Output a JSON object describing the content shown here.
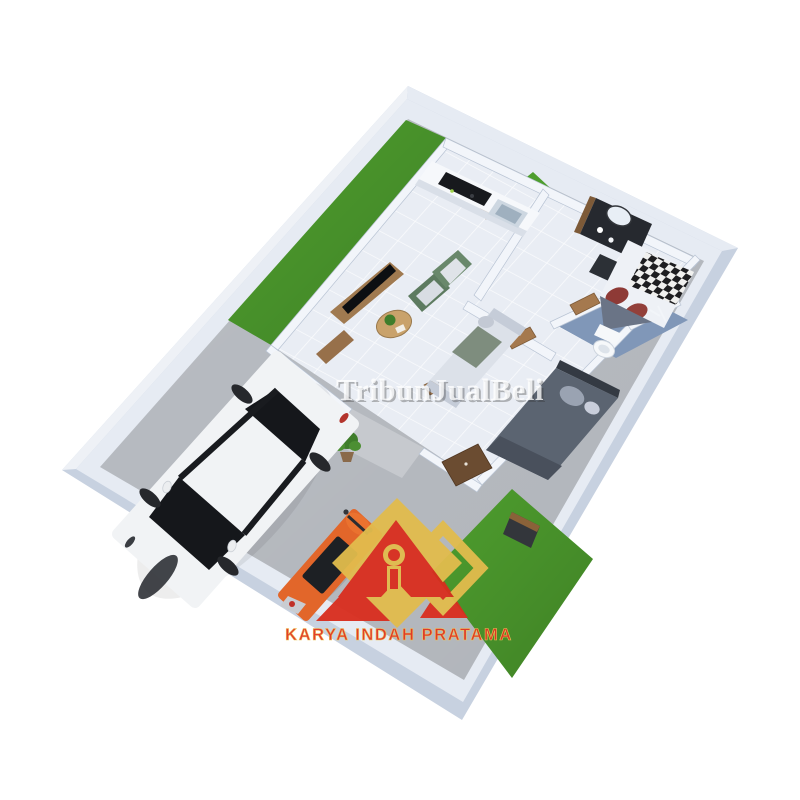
{
  "watermark": {
    "text": "TribunJualBeli"
  },
  "logo": {
    "company_name": "KARYA INDAH PRATAMA"
  },
  "scene": {
    "type": "3d-floor-plan-render",
    "rooms": [
      "carport-driveway",
      "front-garden-strip",
      "kitchen-garden",
      "living-room",
      "kitchen",
      "bedroom-1",
      "bathroom",
      "bedroom-2",
      "backyard-garden"
    ],
    "objects": [
      "white-sedan-car",
      "orange-scooter",
      "tv-console",
      "sofa",
      "armchairs",
      "coffee-table",
      "kitchen-counter",
      "stove",
      "sink",
      "vanity-desk",
      "double-bed-white",
      "double-bed-gray",
      "toilet",
      "wardrobe",
      "laundry-box",
      "potted-plant"
    ]
  },
  "colors": {
    "wall_outer": "#c7d1e0",
    "wall_top": "#e6ebf3",
    "wall_bright": "#eef1f6",
    "concrete": "#b9bdc3",
    "porch": "#c6c9ce",
    "grass": "#4e9e2e",
    "house_floor": "#e9edf4",
    "interior_wall": "#f2f5fa",
    "bathroom_floor": "#8097b8",
    "wood": "#a5794e",
    "counter": "#f6f8fb",
    "appliance_black": "#17191d",
    "steel": "#cdd7e1",
    "bed_linen": "#eef1f6",
    "pillow_red": "#8e3a36",
    "blanket_gray": "#6a7486",
    "bed_gray": "#5b6471",
    "sofa": "#dce1e9",
    "armchair_green": "#5d7b60",
    "armchair_green2": "#69886b",
    "tv_wood": "#a07a50",
    "tv_black": "#0d0f12",
    "table_wood": "#c9a26b",
    "plant_green": "#3f7d2b",
    "car_body": "#f1f3f5",
    "car_glass": "#15171b",
    "car_dark": "#26282c",
    "scooter_orange": "#e2662a",
    "scooter_seat": "#1d2024",
    "wardrobe": "#6b4c31",
    "washer": "#33363b",
    "logo_yellow": "#e2bc4d",
    "logo_red": "#d92d1e",
    "logo_text": "#e23423",
    "logo_text_stroke": "#eec657",
    "watermark_white": "#ffffff"
  }
}
